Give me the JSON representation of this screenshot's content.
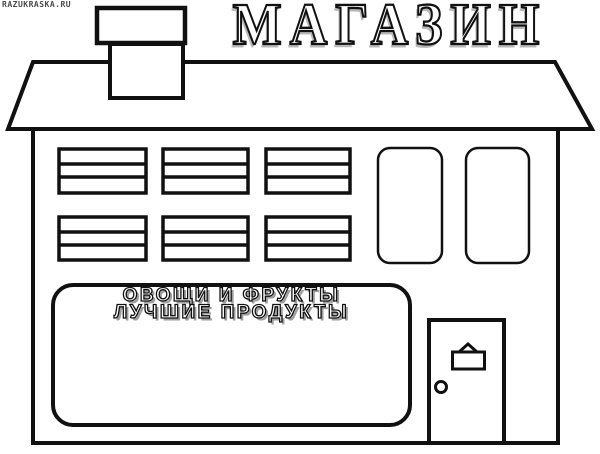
{
  "page": {
    "kind": "coloring-page",
    "subject": "grocery-store-building",
    "background_color": "#ffffff",
    "line_color": "#111111",
    "sign_shadow_color": "#9e9e9e"
  },
  "watermark": {
    "text": "RAZUKRASKA.RU"
  },
  "title": {
    "text": "МАГАЗИН"
  },
  "storefront_sign": {
    "line1": "ОВОЩИ И ФРУКТЫ",
    "line2": "ЛУЧШИЕ ПРОДУКТЫ"
  },
  "scene": {
    "striped_window_count": 6,
    "tall_window_count": 2,
    "has_chimney": true,
    "has_door": true
  }
}
